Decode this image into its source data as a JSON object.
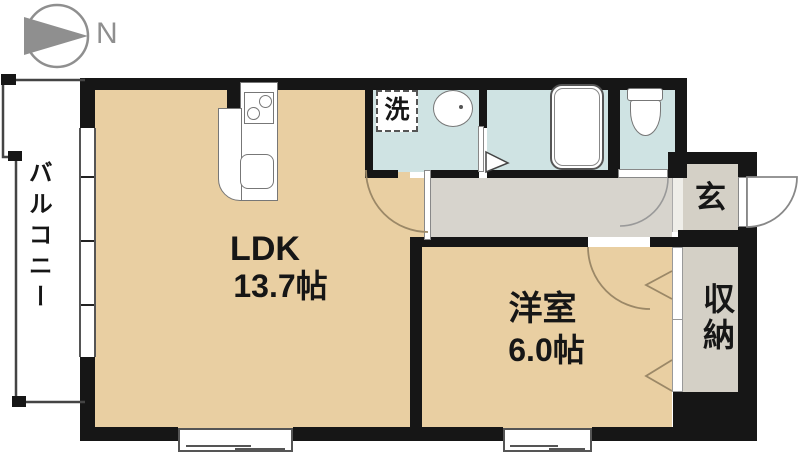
{
  "compass": {
    "label": "N"
  },
  "rooms": {
    "balcony": {
      "label": "バルコニー"
    },
    "ldk": {
      "name": "LDK",
      "size": "13.7帖"
    },
    "bedroom": {
      "name": "洋室",
      "size": "6.0帖"
    },
    "laundry": {
      "label": "洗"
    },
    "entrance": {
      "label": "玄"
    },
    "storage": {
      "label": "収納"
    }
  },
  "colors": {
    "wall": "#161616",
    "room_floor": "#e9cfa2",
    "wet_area_floor": "#cfe3e3",
    "hallway_floor": "#d7d4cd",
    "entry_storage_floor": "#d4d0c6",
    "compass_gray": "#8f8f8f"
  }
}
